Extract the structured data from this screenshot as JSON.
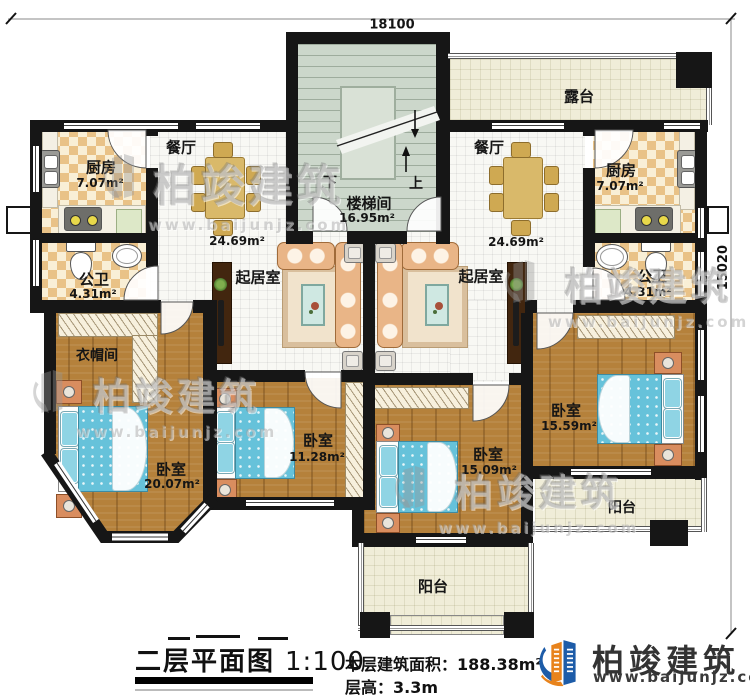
{
  "dims": {
    "width": "18100",
    "depth": "15020"
  },
  "rooms": {
    "terrace": {
      "name": "露台"
    },
    "stair": {
      "name": "楼梯间",
      "area": "16.95m²",
      "down": "下",
      "up": "上"
    },
    "dining": {
      "name": "餐厅",
      "area": "24.69m²"
    },
    "kitchen": {
      "name": "厨房",
      "area": "7.07m²"
    },
    "bath": {
      "name": "公卫",
      "area": "4.31m²"
    },
    "living": {
      "name": "起居室"
    },
    "cloak": {
      "name": "衣帽间"
    },
    "bed_master_l": {
      "name": "卧室",
      "area": "20.07m²"
    },
    "bed_small_l": {
      "name": "卧室",
      "area": "11.28m²"
    },
    "bed_center_r": {
      "name": "卧室",
      "area": "15.09m²"
    },
    "bed_master_r": {
      "name": "卧室",
      "area": "15.59m²"
    },
    "balcony": {
      "name": "阳台"
    }
  },
  "footer": {
    "title": "二层平面图",
    "scale": "1:100",
    "area": "本层建筑面积：188.38m²",
    "floor_height": "层高：3.3m"
  },
  "brand": {
    "name": "柏竣建筑",
    "site": "www.baijunjz.com",
    "blue": "#1d5ca8",
    "orange": "#e8831c"
  }
}
